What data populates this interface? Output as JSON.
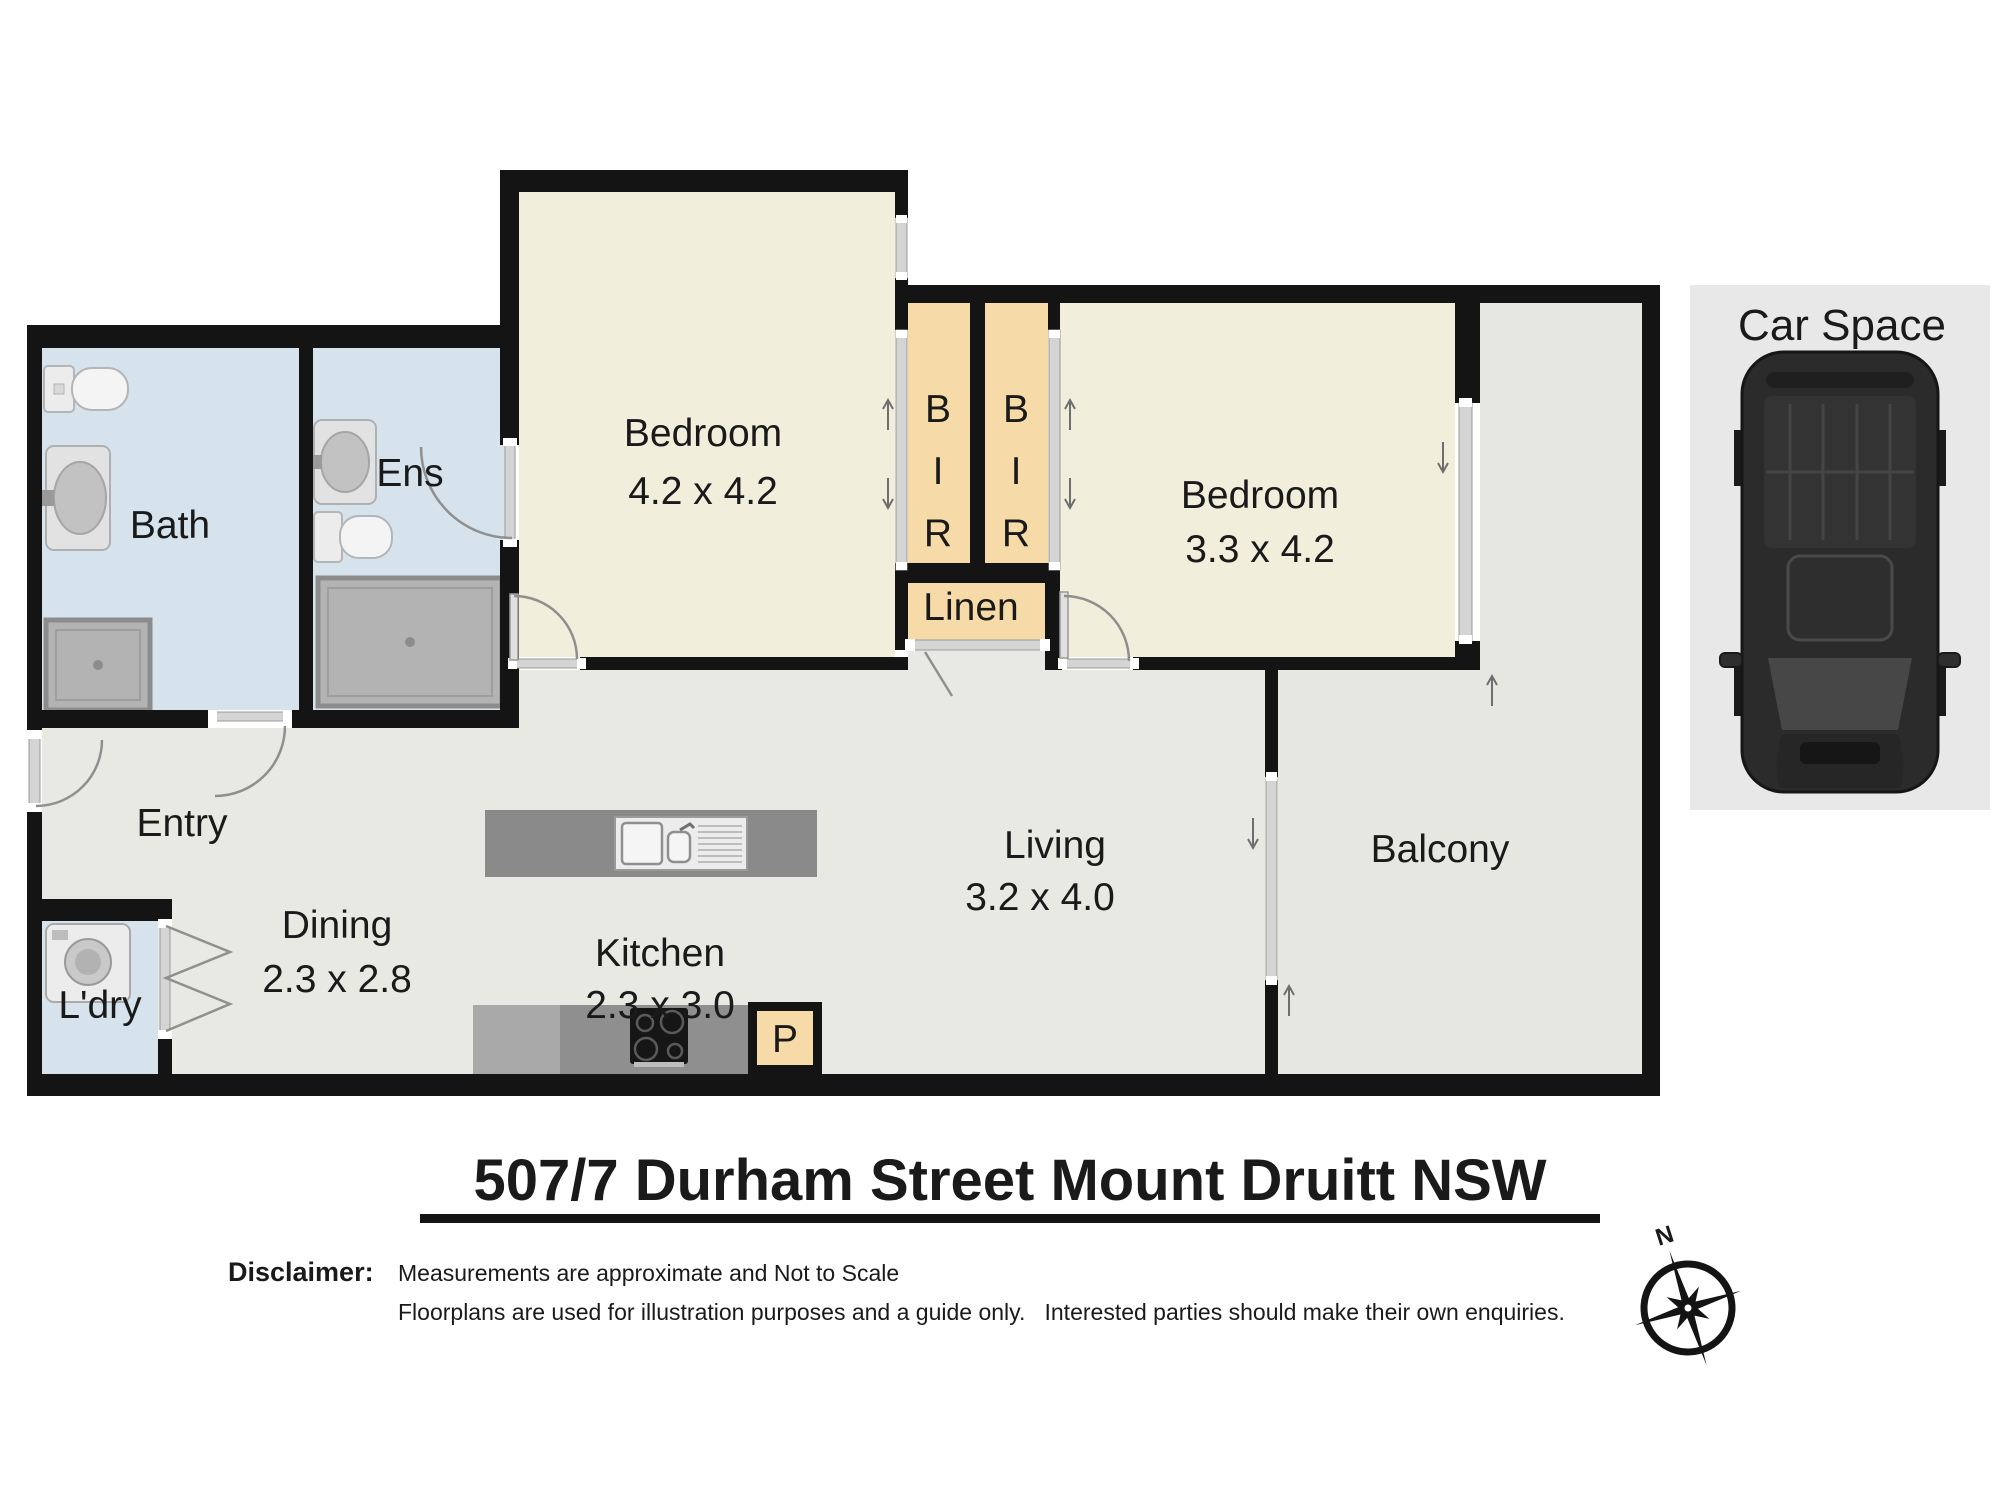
{
  "title": "507/7 Durham Street Mount Druitt  NSW",
  "disclaimer": {
    "label": "Disclaimer:",
    "line1": "Measurements are approximate and Not to Scale",
    "line2": "Floorplans are used for illustration purposes and a guide only.   Interested parties should make their own enquiries."
  },
  "compass": {
    "north": "N"
  },
  "car_space": {
    "label": "Car Space"
  },
  "rooms": {
    "bath": {
      "label": "Bath"
    },
    "ens": {
      "label": "Ens"
    },
    "bedroom1": {
      "label": "Bedroom",
      "dims": "4.2 x 4.2"
    },
    "bedroom2": {
      "label": "Bedroom",
      "dims": "3.3 x 4.2"
    },
    "bir": {
      "b": "B",
      "i": "I",
      "r": "R"
    },
    "linen": {
      "label": "Linen"
    },
    "entry": {
      "label": "Entry"
    },
    "dining": {
      "label": "Dining",
      "dims": "2.3 x 2.8"
    },
    "kitchen": {
      "label": "Kitchen",
      "dims": "2.3 x 3.0"
    },
    "living": {
      "label": "Living",
      "dims": "3.2 x 4.0"
    },
    "laundry": {
      "label": "L'dry"
    },
    "balcony": {
      "label": "Balcony"
    },
    "pantry": {
      "label": "P"
    }
  },
  "colors": {
    "wall": "#141414",
    "bedroom_floor": "#f1eedc",
    "wet_floor": "#d6e3ed",
    "living_floor": "#e9e9e3",
    "balcony_floor": "#e7e7e2",
    "robe_floor": "#f6dba8",
    "car_space_bg": "#e8e8e8"
  }
}
